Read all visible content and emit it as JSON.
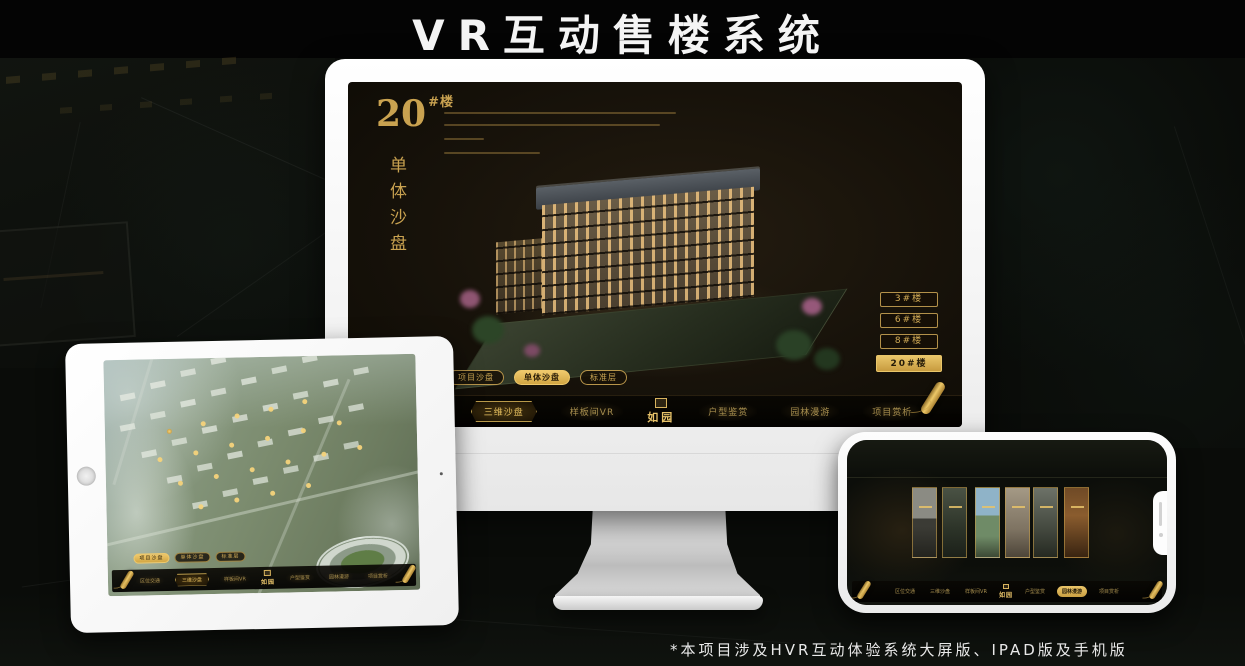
{
  "page": {
    "title": "VR互动售楼系统",
    "footnote": "*本项目涉及HVR互动体验系统大屏版、IPAD版及手机版"
  },
  "nav": {
    "logo": "如园",
    "active": "三维沙盘",
    "items": [
      {
        "label": "区位交通"
      },
      {
        "label": "三维沙盘"
      },
      {
        "label": "样板间VR"
      },
      {
        "label": "户型鉴赏"
      },
      {
        "label": "园林漫游"
      },
      {
        "label": "项目赏析"
      }
    ]
  },
  "sub_tabs": {
    "monitor": [
      {
        "label": "项目沙盘",
        "active": false
      },
      {
        "label": "单体沙盘",
        "active": true
      },
      {
        "label": "标准层",
        "active": false
      }
    ],
    "tablet": [
      {
        "label": "项目沙盘",
        "active": true
      },
      {
        "label": "单体沙盘",
        "active": false
      },
      {
        "label": "标准层",
        "active": false
      }
    ]
  },
  "monitor": {
    "building_no": "20",
    "building_suffix": "#楼",
    "vertical_title": "单体沙盘",
    "floor_buttons": [
      {
        "label": "3#楼",
        "active": false
      },
      {
        "label": "6#楼",
        "active": false
      },
      {
        "label": "8#楼",
        "active": false
      },
      {
        "label": "20#楼",
        "active": true
      }
    ]
  },
  "phone": {
    "active_nav": "园林漫游",
    "panel_count": 6
  },
  "colors": {
    "gold": "#c79f4e",
    "gold_bright": "#e8c36a",
    "screen_bg": "#17120a"
  }
}
